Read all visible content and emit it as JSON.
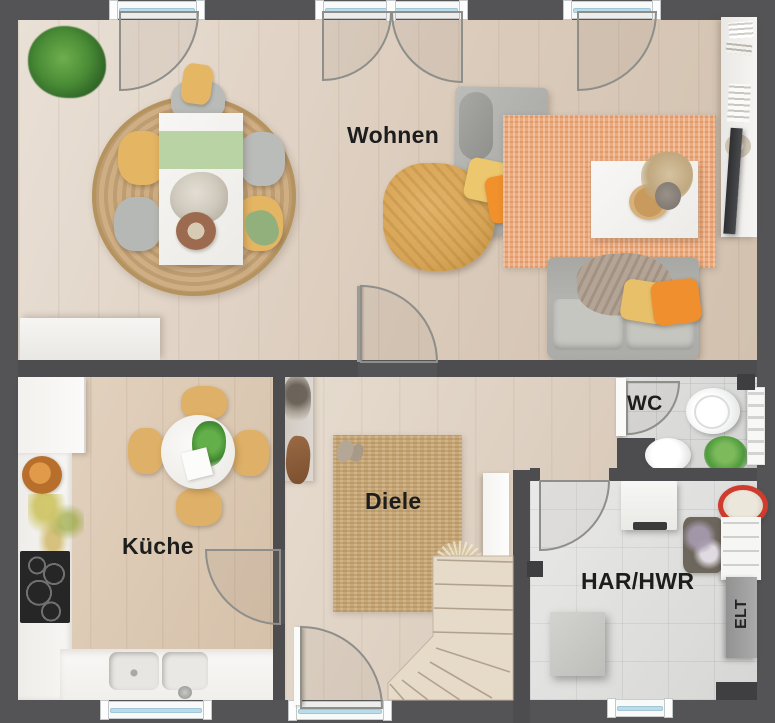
{
  "rooms": {
    "wohnen": {
      "label": "Wohnen"
    },
    "kueche": {
      "label": "Küche"
    },
    "diele": {
      "label": "Diele"
    },
    "wc": {
      "label": "WC"
    },
    "har_hwr": {
      "label": "HAR/HWR"
    },
    "elt": {
      "label": "ELT"
    }
  },
  "colors": {
    "wall": "#4d4d4f",
    "outer_background": "#545456",
    "wood_floor": "#dccdbd",
    "kitchen_floor": "#dbc8b2",
    "tile_floor": "#d8d8d7",
    "round_rug": "#c9aa81",
    "orange_rug": "#edaa7c",
    "jute_rug": "#c9a878",
    "sofa_gray": "#b0b0ad",
    "mustard_throw": "#d7a557",
    "orange_pillow": "#f0912c",
    "yellow_pillow": "#edc76d",
    "chair_yellow": "#e2b465",
    "table_runner_green": "#b9d3a5",
    "plant_green": "#57a13d",
    "laundry_basket_red": "#cf3b2c",
    "furniture_white": "#f5f4f1",
    "window_glass": "#badbe9",
    "stair_wood": "#e4d8c7",
    "label_text": "#1d1d1d"
  }
}
